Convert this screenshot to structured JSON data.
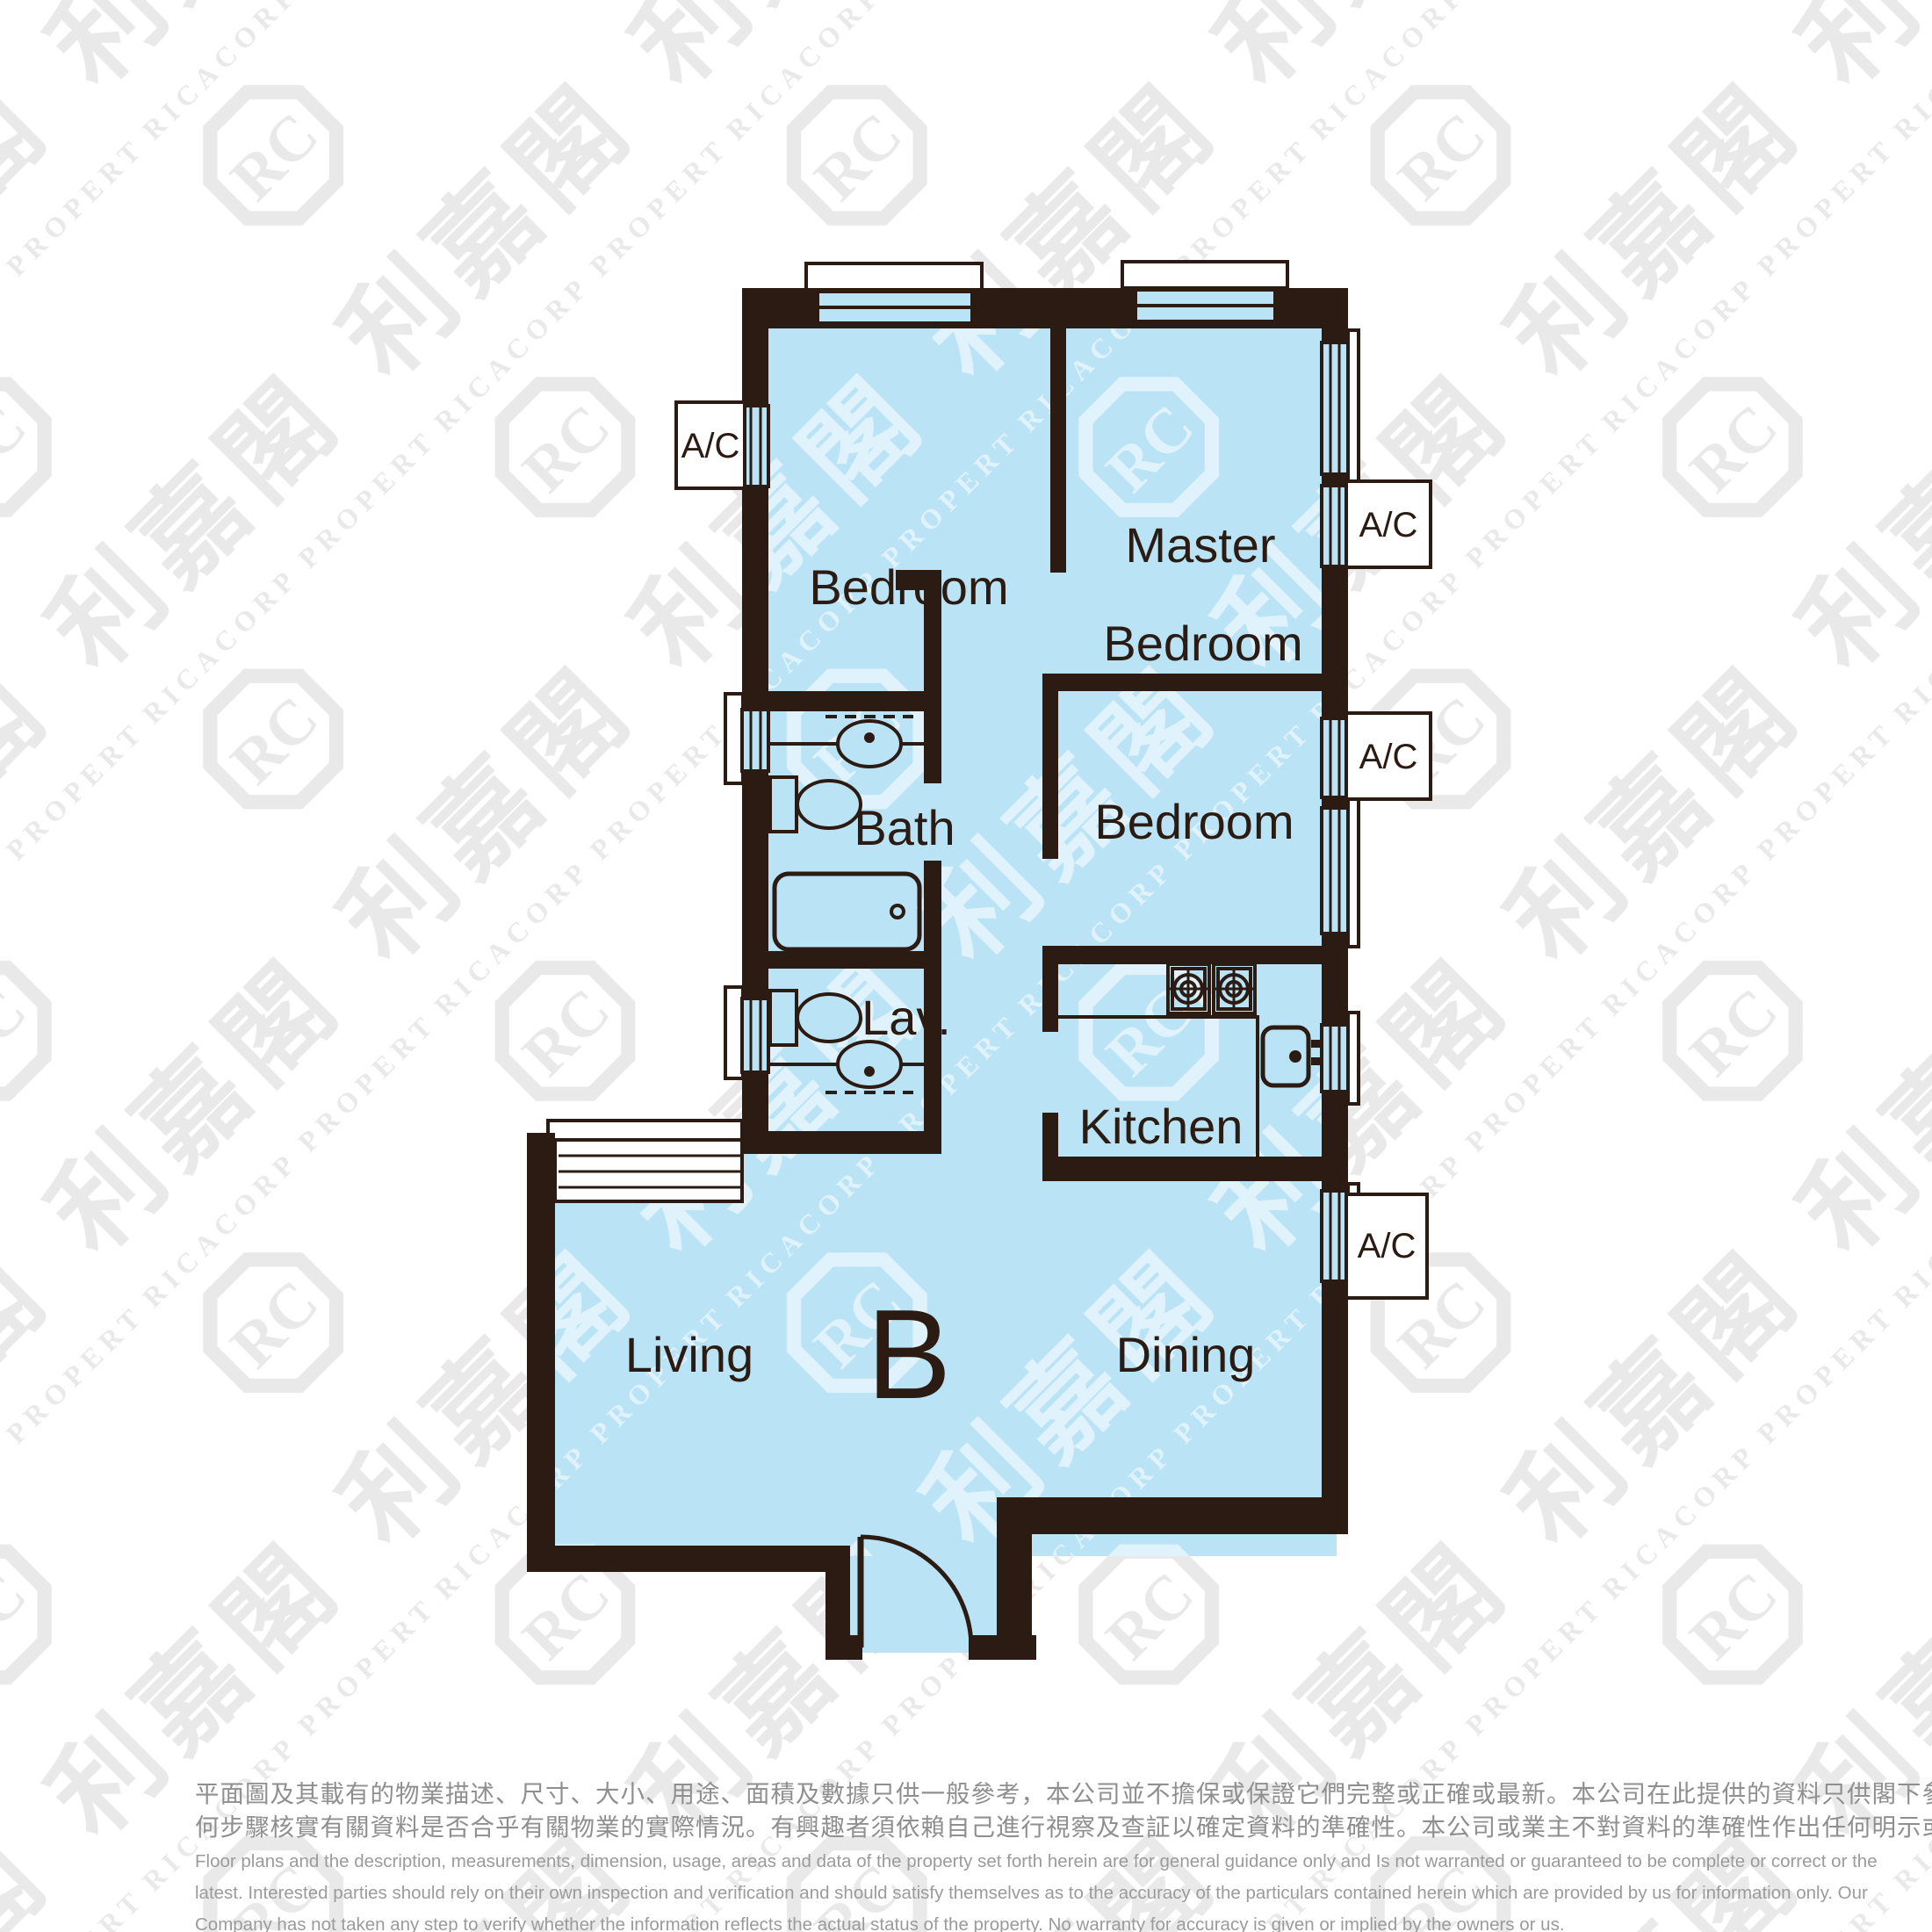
{
  "colors": {
    "wall": "#2b1b12",
    "floor": "#bae3f5",
    "white": "#ffffff",
    "watermark_gray": "#e9e9e9",
    "disclaimer_zh": "#8f8f8f",
    "disclaimer_en": "#9b9b9b"
  },
  "unit": {
    "label": "B"
  },
  "rooms": {
    "bedroom_top": {
      "label": "Bedroom"
    },
    "master": {
      "line1": "Master",
      "line2": "Bedroom"
    },
    "bedroom_mid": {
      "label": "Bedroom"
    },
    "bath": {
      "label": "Bath"
    },
    "lav": {
      "label": "Lav."
    },
    "kitchen": {
      "label": "Kitchen"
    },
    "living": {
      "label": "Living"
    },
    "dining": {
      "label": "Dining"
    }
  },
  "ac": {
    "label": "A/C"
  },
  "watermark": {
    "cjk": "利嘉閣",
    "latin": "RICACORP PROPERTIES",
    "monogram": "RC"
  },
  "disclaimer": {
    "zh_lines": [
      "平面圖及其載有的物業描述、尺寸、大小、用途、面積及數據只供一般參考，本公司並不擔保或保證它們完整或正確或最新。本公司在此提供的資料只供閣下參考，本公司並無採取任",
      "何步驟核實有關資料是否合乎有關物業的實際情況。有興趣者須依賴自己進行視察及查証以確定資料的準確性。本公司或業主不對資料的準確性作出任何明示或隱含的保證。"
    ],
    "en_lines": [
      "Floor plans and the description, measurements, dimension, usage, areas and data of the property set forth herein are for general guidance only and Is not warranted or guaranteed to be complete or correct or the",
      "latest. Interested parties should rely on their own inspection and verification and should satisfy themselves as to the accuracy of the particulars contained herein which are provided by us for information only.  Our",
      "Company has not taken any step to verify whether the information reflects the actual status of the property.  No warranty for accuracy is given or implied by the owners or us."
    ]
  }
}
